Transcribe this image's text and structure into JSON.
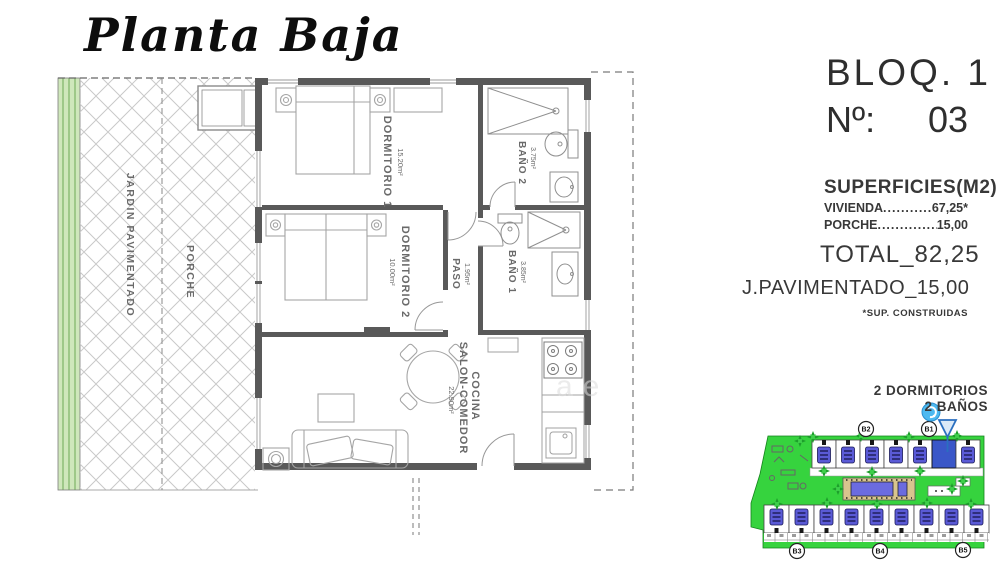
{
  "title": "Planta Baja",
  "info_panel": {
    "block_label": "BLOQ. 1",
    "number_label": "Nº:",
    "number_value": "03",
    "surfaces_title": "SUPERFICIES(M2)",
    "surface_rows": [
      {
        "label": "VIVIENDA",
        "dots": "......................",
        "value": "67,25*"
      },
      {
        "label": "PORCHE",
        "dots": "......................",
        "value": "15,00"
      }
    ],
    "total": {
      "label": "TOTAL",
      "sep": "_",
      "value": "82,25"
    },
    "paved": {
      "label": "J.PAVIMENTADO",
      "sep": "_",
      "value": "15,00"
    },
    "footnote": "*SUP. CONSTRUIDAS",
    "features": {
      "bedrooms": "2 DORMITORIOS",
      "bathrooms": "2 BAÑOS"
    }
  },
  "floor_plan": {
    "jardin": {
      "label": "JARDIN PAVIMENTADO"
    },
    "porche": {
      "label": "PORCHE"
    },
    "dormitorio1": {
      "label": "DORMITORIO 1",
      "area": "15.20m²"
    },
    "bano2": {
      "label": "BAÑO 2",
      "area": "3.75m²"
    },
    "dormitorio2": {
      "label": "DORMITORIO 2",
      "area": "10.00m²"
    },
    "paso": {
      "label": "PASO",
      "area": "1.95m²"
    },
    "bano1": {
      "label": "BAÑO 1",
      "area": "3.85m²"
    },
    "cocina": {
      "label_line1": "COCINA",
      "label_line2": "SALON-COMEDOR",
      "area": "22.90m²"
    },
    "watermark": "ae"
  },
  "site_plan": {
    "markers_top": [
      "B2",
      "B1"
    ],
    "markers_bottom": [
      "B3",
      "B4",
      "B5"
    ],
    "highlight_color": "#3a57c8",
    "grass_color": "#36d33e",
    "pool_color": "#6b6be0"
  }
}
